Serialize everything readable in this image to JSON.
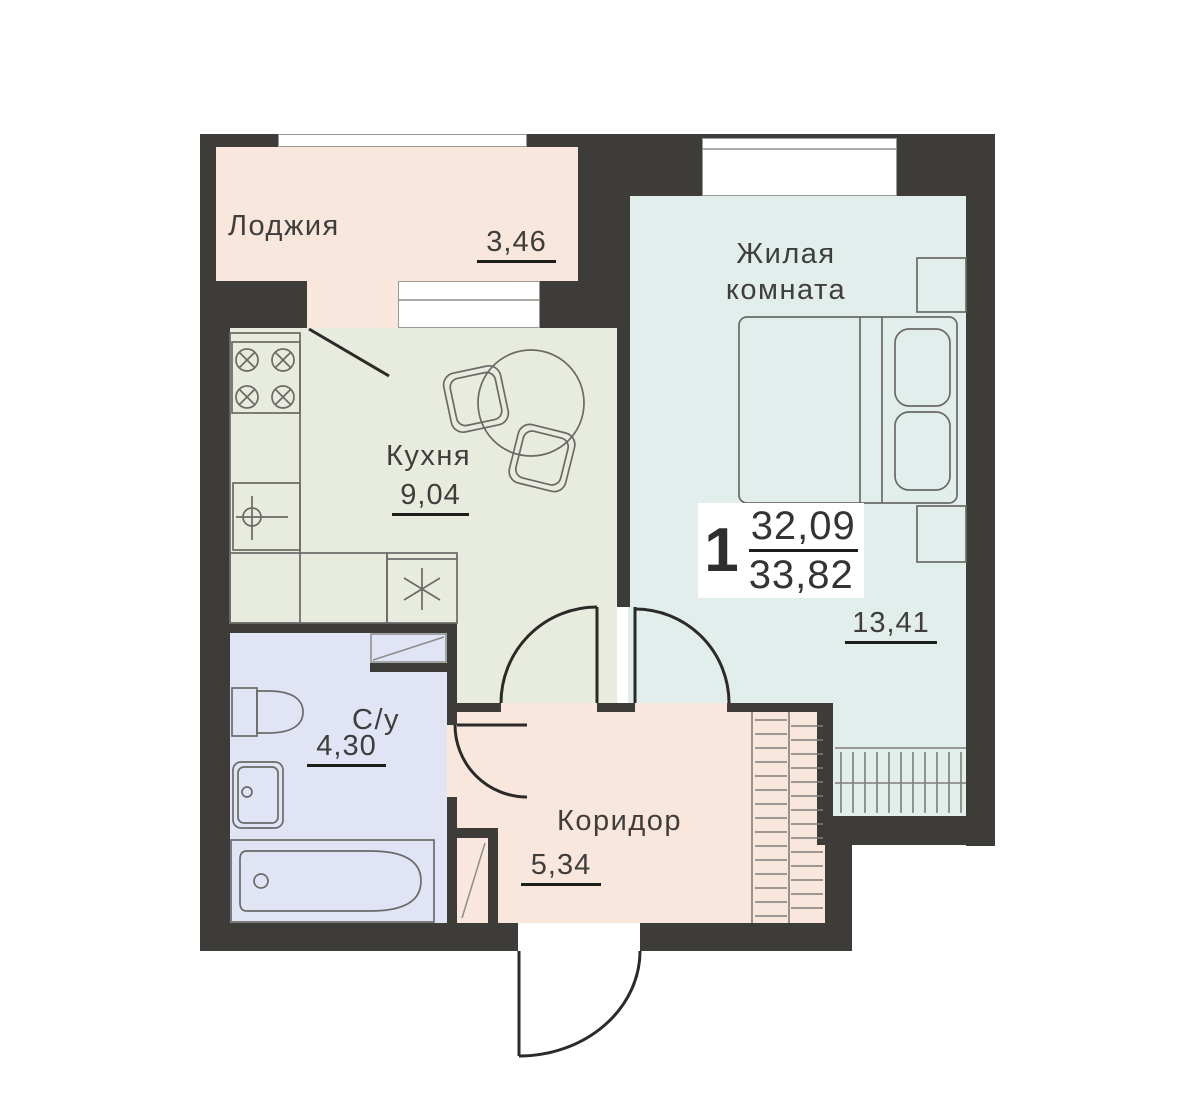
{
  "summary": {
    "rooms_count": "1",
    "living_area": "32,09",
    "total_area": "33,82"
  },
  "rooms": [
    {
      "name": "loggia",
      "label": "Лоджия",
      "area": "3,46"
    },
    {
      "name": "kitchen",
      "label": "Кухня",
      "area": "9,04"
    },
    {
      "name": "living-room",
      "label": "Жилая комната",
      "area": "13,41"
    },
    {
      "name": "bathroom",
      "label": "С/у",
      "area": "4,30"
    },
    {
      "name": "corridor",
      "label": "Коридор",
      "area": "5,34"
    }
  ],
  "colors": {
    "wall": "#3d3c39",
    "loggia": "#f9e7dd",
    "kitchen": "#e8ecdf",
    "living": "#e2eeec",
    "bathroom": "#e0e4f4",
    "corridor": "#f9e7dd",
    "furniture": "#6a6a67",
    "door": "#2b2a28",
    "text": "#3f3e3c",
    "underline": "#1d1d1a",
    "window_frame": "#9a9a97"
  }
}
